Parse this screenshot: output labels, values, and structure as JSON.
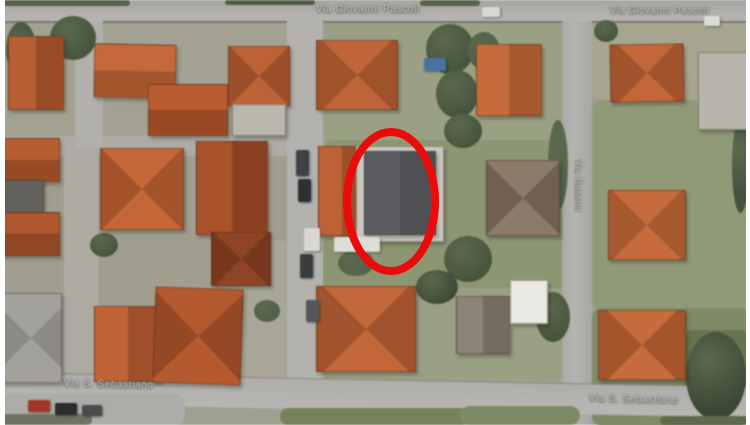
{
  "streets": {
    "top_center": "Via Giovanni Pascoli",
    "top_right": "Via Giovanni Pascoli",
    "right_vertical": "Via Rossini",
    "bottom_left": "Via S. Sebastiano",
    "bottom_right": "Via S. Sebastiano"
  },
  "highlight": {
    "shape": "ellipse",
    "color": "#ec0a0a"
  },
  "lawns": [
    {
      "x": 0,
      "y": 21,
      "w": 290,
      "h": 122,
      "c": "#a3a292"
    },
    {
      "x": 325,
      "y": 21,
      "w": 240,
      "h": 125,
      "c": "#99a083"
    },
    {
      "x": 592,
      "y": 21,
      "w": 158,
      "h": 80,
      "c": "#a6a690"
    },
    {
      "x": 0,
      "y": 155,
      "w": 288,
      "h": 225,
      "c": "#a19e8f"
    },
    {
      "x": 64,
      "y": 150,
      "w": 34,
      "h": 228,
      "c": "#aeaca0"
    },
    {
      "x": 240,
      "y": 240,
      "w": 48,
      "h": 140,
      "c": "#a8a699"
    },
    {
      "x": 323,
      "y": 140,
      "w": 242,
      "h": 150,
      "c": "#8d9673"
    },
    {
      "x": 592,
      "y": 100,
      "w": 158,
      "h": 210,
      "c": "#909a77"
    },
    {
      "x": 323,
      "y": 288,
      "w": 242,
      "h": 92,
      "c": "#9aa084"
    },
    {
      "x": 592,
      "y": 308,
      "w": 158,
      "h": 118,
      "c": "#7f8b66"
    },
    {
      "x": 684,
      "y": 330,
      "w": 66,
      "h": 95,
      "c": "#66744f"
    },
    {
      "x": 0,
      "y": 394,
      "w": 185,
      "h": 31,
      "c": "#adaca8",
      "z": 7
    },
    {
      "x": 0,
      "y": 414,
      "w": 92,
      "h": 11,
      "c": "#70735f",
      "z": 7
    },
    {
      "x": 280,
      "y": 408,
      "w": 190,
      "h": 17,
      "c": "#75825c",
      "z": 7
    },
    {
      "x": 460,
      "y": 406,
      "w": 120,
      "h": 19,
      "c": "#7e8a64",
      "z": 7
    },
    {
      "x": 660,
      "y": 416,
      "w": 90,
      "h": 9,
      "c": "#5d6a4b",
      "z": 7
    },
    {
      "x": 0,
      "y": 0,
      "w": 130,
      "h": 6,
      "c": "#57624a",
      "z": 7
    },
    {
      "x": 225,
      "y": 0,
      "w": 90,
      "h": 5,
      "c": "#4e5a44",
      "z": 7
    },
    {
      "x": 420,
      "y": 0,
      "w": 60,
      "h": 6,
      "c": "#57624a",
      "z": 7
    }
  ],
  "trees": [
    {
      "x": 50,
      "y": 16,
      "w": 46,
      "h": 44,
      "c": "#47553c"
    },
    {
      "x": 6,
      "y": 22,
      "w": 30,
      "h": 55,
      "c": "#3e4a36"
    },
    {
      "x": 426,
      "y": 24,
      "w": 48,
      "h": 50,
      "c": "#47553c"
    },
    {
      "x": 436,
      "y": 70,
      "w": 42,
      "h": 48,
      "c": "#47553c"
    },
    {
      "x": 444,
      "y": 114,
      "w": 38,
      "h": 34,
      "c": "#47553c"
    },
    {
      "x": 468,
      "y": 32,
      "w": 32,
      "h": 38,
      "c": "#51604a"
    },
    {
      "x": 444,
      "y": 236,
      "w": 48,
      "h": 46,
      "c": "#47553c"
    },
    {
      "x": 416,
      "y": 270,
      "w": 42,
      "h": 34,
      "c": "#3f4c37"
    },
    {
      "x": 536,
      "y": 292,
      "w": 34,
      "h": 50,
      "c": "#47553c"
    },
    {
      "x": 686,
      "y": 332,
      "w": 60,
      "h": 88,
      "c": "#3c4834"
    },
    {
      "x": 594,
      "y": 20,
      "w": 24,
      "h": 22,
      "c": "#47553c"
    },
    {
      "x": 338,
      "y": 250,
      "w": 36,
      "h": 26,
      "c": "#53624a"
    },
    {
      "x": 90,
      "y": 233,
      "w": 28,
      "h": 24,
      "c": "#47553c"
    },
    {
      "x": 0,
      "y": 220,
      "w": 22,
      "h": 32,
      "c": "#3f4c37"
    },
    {
      "x": 732,
      "y": 118,
      "w": 17,
      "h": 95,
      "c": "#44523c"
    },
    {
      "x": 548,
      "y": 120,
      "w": 20,
      "h": 90,
      "c": "#55644a"
    },
    {
      "x": 254,
      "y": 300,
      "w": 26,
      "h": 22,
      "c": "#51604a"
    }
  ],
  "houses": [
    {
      "x": 8,
      "y": 36,
      "w": 54,
      "h": 72,
      "type": "gv",
      "c1": "#b65f33",
      "c2": "#9a4c27",
      "rot": 0
    },
    {
      "x": 94,
      "y": 44,
      "w": 80,
      "h": 52,
      "type": "gh",
      "c1": "#c4693b",
      "c2": "#a5552c",
      "rot": 1
    },
    {
      "x": 148,
      "y": 84,
      "w": 78,
      "h": 50,
      "type": "gh",
      "c1": "#b85c30",
      "c2": "#994a25",
      "rot": 0
    },
    {
      "x": 228,
      "y": 46,
      "w": 60,
      "h": 58,
      "type": "hip",
      "c1": "#bd6136",
      "c2": "#9c4e28",
      "rot": 0
    },
    {
      "x": 232,
      "y": 104,
      "w": 52,
      "h": 30,
      "type": "flat",
      "c1": "#b9b7ae",
      "c2": "#a3a198",
      "rot": 0
    },
    {
      "x": 316,
      "y": 40,
      "w": 80,
      "h": 68,
      "type": "hip",
      "c1": "#c0653a",
      "c2": "#a0522b",
      "rot": 0
    },
    {
      "x": 476,
      "y": 44,
      "w": 64,
      "h": 70,
      "type": "gv",
      "c1": "#c66c3c",
      "c2": "#a6582e",
      "rot": 0
    },
    {
      "x": 610,
      "y": 44,
      "w": 72,
      "h": 56,
      "type": "hip",
      "c1": "#c2673a",
      "c2": "#a3532c",
      "rot": -1
    },
    {
      "x": 698,
      "y": 52,
      "w": 50,
      "h": 76,
      "type": "flat",
      "c1": "#b7b5ac",
      "c2": "#a19f96",
      "rot": 0
    },
    {
      "x": 0,
      "y": 138,
      "w": 58,
      "h": 42,
      "type": "gh",
      "c1": "#b65c31",
      "c2": "#974a26",
      "rot": 0
    },
    {
      "x": 4,
      "y": 180,
      "w": 38,
      "h": 32,
      "type": "flat",
      "c1": "#63625d",
      "c2": "#63625d",
      "rot": 0
    },
    {
      "x": 0,
      "y": 212,
      "w": 58,
      "h": 42,
      "type": "gh",
      "c1": "#ae5630",
      "c2": "#914625",
      "rot": 0
    },
    {
      "x": 100,
      "y": 148,
      "w": 82,
      "h": 80,
      "type": "hip",
      "c1": "#c46739",
      "c2": "#a4532b",
      "rot": 0
    },
    {
      "x": 196,
      "y": 141,
      "w": 70,
      "h": 92,
      "type": "gv",
      "c1": "#a9522b",
      "c2": "#8b4121",
      "rot": 0
    },
    {
      "x": 211,
      "y": 232,
      "w": 58,
      "h": 52,
      "type": "hip",
      "c1": "#8f4525",
      "c2": "#76371d",
      "rot": 0
    },
    {
      "x": 318,
      "y": 146,
      "w": 46,
      "h": 88,
      "type": "gv",
      "c1": "#bd6136",
      "c2": "#9c4e28",
      "rot": 0
    },
    {
      "x": 356,
      "y": 146,
      "w": 86,
      "h": 94,
      "type": "flat",
      "c1": "#c9c7c0",
      "c2": "#b4b2aa",
      "rot": 0,
      "name": "highlighted-building-frame"
    },
    {
      "x": 364,
      "y": 151,
      "w": 70,
      "h": 82,
      "type": "gv",
      "c1": "#5b5c60",
      "c2": "#4f5054",
      "rot": 0,
      "name": "highlighted-building-roof"
    },
    {
      "x": 486,
      "y": 160,
      "w": 72,
      "h": 74,
      "type": "hip",
      "c1": "#8b7b6a",
      "c2": "#6f604f",
      "rot": 0
    },
    {
      "x": 608,
      "y": 190,
      "w": 76,
      "h": 68,
      "type": "hip",
      "c1": "#c66c3c",
      "c2": "#a6582e",
      "rot": 0
    },
    {
      "x": 0,
      "y": 293,
      "w": 60,
      "h": 88,
      "type": "hip",
      "c1": "#a2a19b",
      "c2": "#8b8a84",
      "rot": 0
    },
    {
      "x": 94,
      "y": 306,
      "w": 66,
      "h": 74,
      "type": "gv",
      "c1": "#c06438",
      "c2": "#9f502a",
      "rot": 0
    },
    {
      "x": 154,
      "y": 288,
      "w": 86,
      "h": 94,
      "type": "hip",
      "c1": "#b55a2f",
      "c2": "#954826",
      "rot": 2
    },
    {
      "x": 316,
      "y": 286,
      "w": 98,
      "h": 84,
      "type": "hip",
      "c1": "#c2673a",
      "c2": "#a0532c",
      "rot": 0
    },
    {
      "x": 456,
      "y": 296,
      "w": 52,
      "h": 56,
      "type": "gv",
      "c1": "#8d8376",
      "c2": "#756c60",
      "rot": 0
    },
    {
      "x": 510,
      "y": 280,
      "w": 36,
      "h": 42,
      "type": "flat",
      "c1": "#e9e8e3",
      "c2": "#d6d5cf",
      "rot": 0
    },
    {
      "x": 598,
      "y": 310,
      "w": 86,
      "h": 68,
      "type": "hip",
      "c1": "#c66c3c",
      "c2": "#a4552c",
      "rot": 0
    }
  ],
  "cars": [
    {
      "x": 482,
      "y": 7,
      "w": 18,
      "h": 10,
      "c": "#d8d7d1"
    },
    {
      "x": 704,
      "y": 16,
      "w": 16,
      "h": 10,
      "c": "#dcdbd5"
    },
    {
      "x": 424,
      "y": 58,
      "w": 22,
      "h": 13,
      "c": "#4a72a0",
      "name": "pool"
    },
    {
      "x": 296,
      "y": 150,
      "w": 13,
      "h": 26,
      "c": "#3f4142"
    },
    {
      "x": 298,
      "y": 179,
      "w": 13,
      "h": 23,
      "c": "#2e2f30"
    },
    {
      "x": 304,
      "y": 228,
      "w": 16,
      "h": 23,
      "c": "#d9d8d2"
    },
    {
      "x": 300,
      "y": 254,
      "w": 13,
      "h": 24,
      "c": "#3a3b3c"
    },
    {
      "x": 306,
      "y": 300,
      "w": 13,
      "h": 22,
      "c": "#55565a"
    },
    {
      "x": 334,
      "y": 237,
      "w": 46,
      "h": 15,
      "c": "#dddcd6",
      "name": "van"
    },
    {
      "x": 28,
      "y": 400,
      "w": 22,
      "h": 12,
      "c": "#a23527"
    },
    {
      "x": 55,
      "y": 403,
      "w": 22,
      "h": 12,
      "c": "#2c2d2e"
    },
    {
      "x": 82,
      "y": 405,
      "w": 20,
      "h": 11,
      "c": "#4a4b4c"
    }
  ]
}
